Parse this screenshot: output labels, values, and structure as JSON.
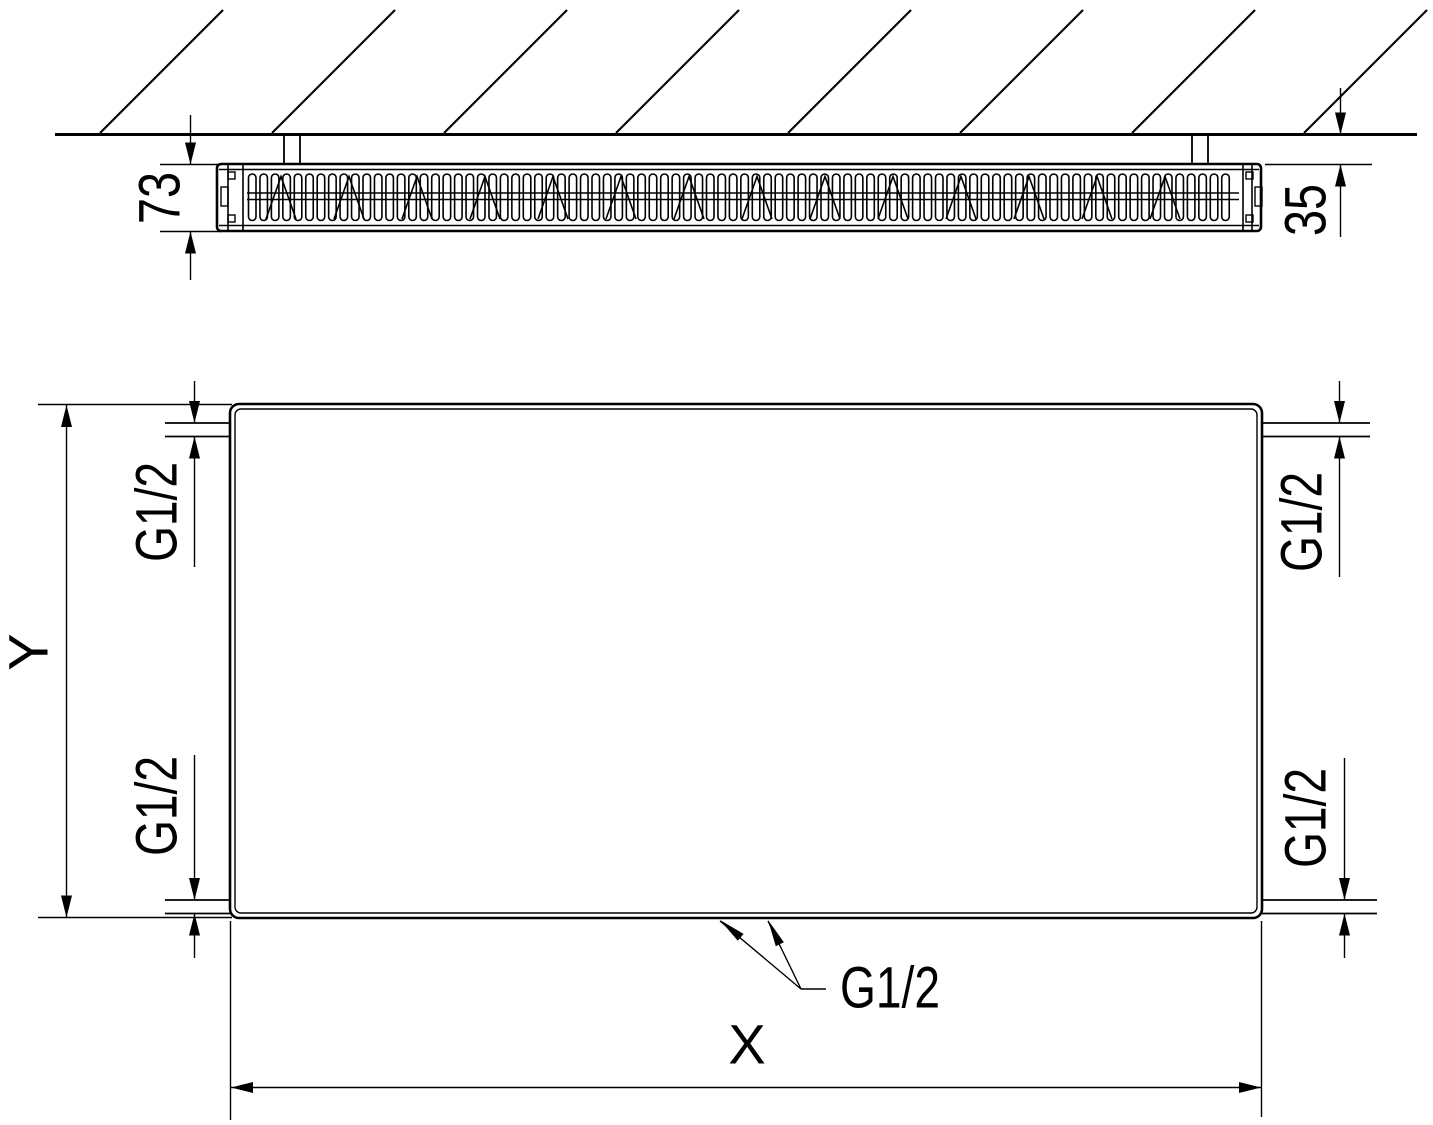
{
  "colors": {
    "line": "#000000",
    "background": "#ffffff"
  },
  "top_view": {
    "depth_dim": "73",
    "wall_offset_dim": "35"
  },
  "front_view": {
    "height_dim": "Y",
    "width_dim": "X",
    "conn_top_left": "G1/2",
    "conn_top_right": "G1/2",
    "conn_bottom_left": "G1/2",
    "conn_bottom_right": "G1/2",
    "conn_bottom_center": "G1/2"
  }
}
